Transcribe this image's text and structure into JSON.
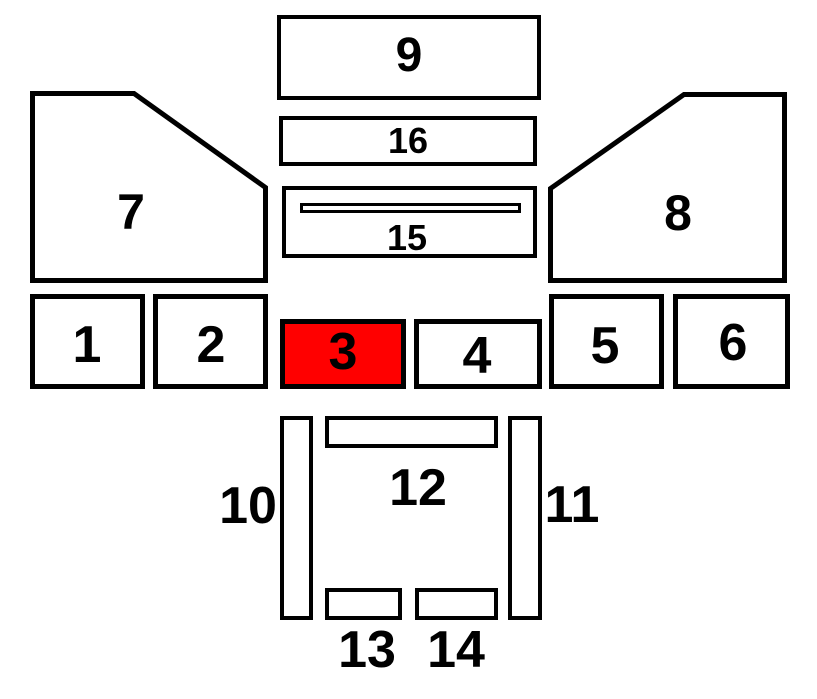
{
  "diagram": {
    "colors": {
      "highlight": "#ff0000",
      "stroke": "#000000",
      "background": "#ffffff"
    },
    "selected_part": "3",
    "parts": [
      {
        "id": "1",
        "label": "1",
        "highlighted": false
      },
      {
        "id": "2",
        "label": "2",
        "highlighted": false
      },
      {
        "id": "3",
        "label": "3",
        "highlighted": true
      },
      {
        "id": "4",
        "label": "4",
        "highlighted": false
      },
      {
        "id": "5",
        "label": "5",
        "highlighted": false
      },
      {
        "id": "6",
        "label": "6",
        "highlighted": false
      },
      {
        "id": "7",
        "label": "7",
        "highlighted": false
      },
      {
        "id": "8",
        "label": "8",
        "highlighted": false
      },
      {
        "id": "9",
        "label": "9",
        "highlighted": false
      },
      {
        "id": "10",
        "label": "10",
        "highlighted": false
      },
      {
        "id": "11",
        "label": "11",
        "highlighted": false
      },
      {
        "id": "12",
        "label": "12",
        "highlighted": false
      },
      {
        "id": "13",
        "label": "13",
        "highlighted": false
      },
      {
        "id": "14",
        "label": "14",
        "highlighted": false
      },
      {
        "id": "15",
        "label": "15",
        "highlighted": false
      },
      {
        "id": "16",
        "label": "16",
        "highlighted": false
      }
    ]
  }
}
